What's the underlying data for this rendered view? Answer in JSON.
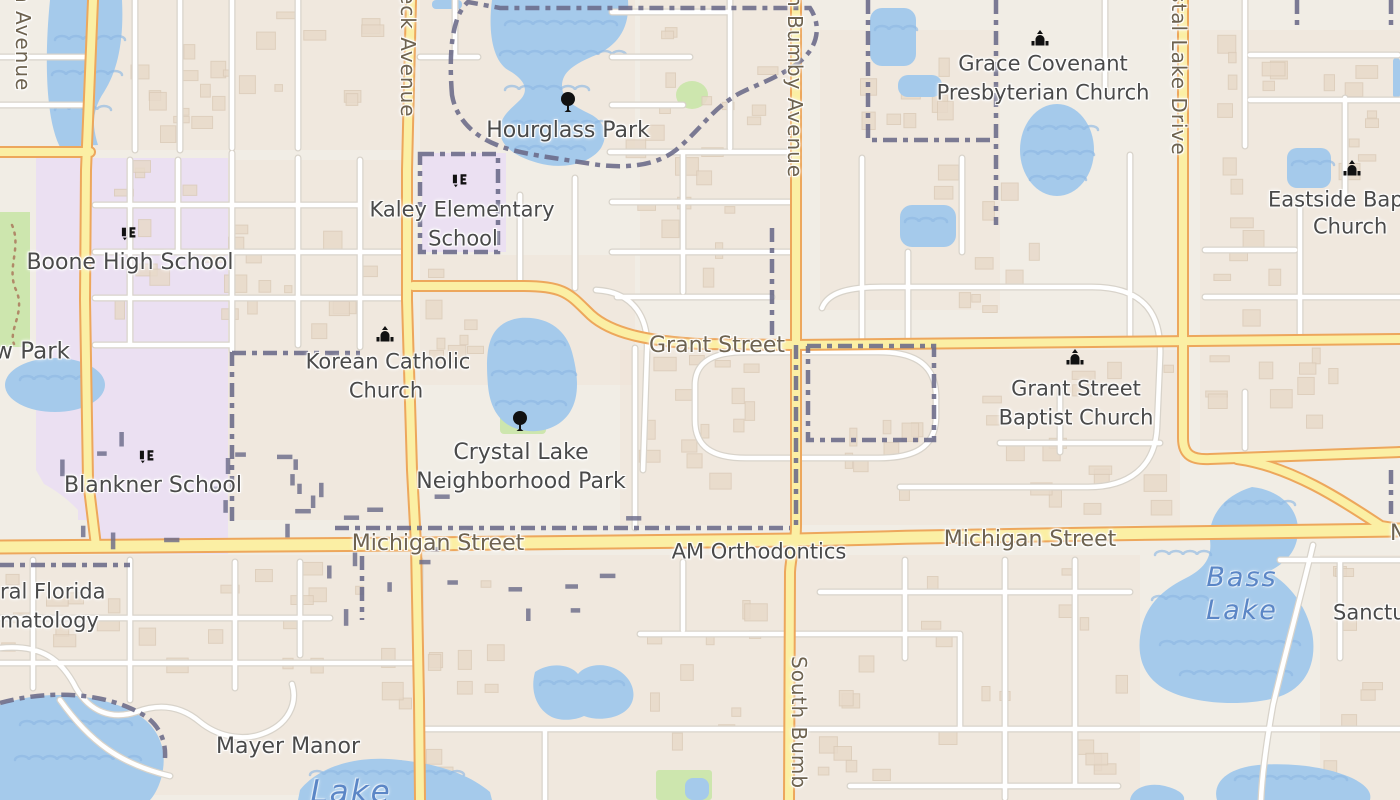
{
  "map": {
    "description": "Street map of a neighborhood (Orlando area) with schools, churches, parks and lakes",
    "colors": {
      "land": "#F1EDE5",
      "residential": "#EFE3D5",
      "water": "#A5CAEB",
      "water_wave": "#8FB9E4",
      "road_fill": "#FBEFA4",
      "road_casing": "#EDA75C",
      "street_fill": "#FFFFFF",
      "street_casing": "#D8D3CA",
      "boundary": "#6A6A89",
      "school": "#EBE0F2",
      "park": "#CDE6AE",
      "building": "#E8DACA",
      "building_stroke": "#DBCBB8",
      "poi_label": "#4A4A4A",
      "road_label": "#6E6350",
      "water_label": "#5B86C6",
      "icon": "#111111"
    },
    "labels": [
      {
        "id": "hourglass-park",
        "text": "Hourglass Park",
        "x": 568,
        "y": 131,
        "type": "poi",
        "size": 22
      },
      {
        "id": "kaley-school-line1",
        "text": "Kaley Elementary",
        "x": 462,
        "y": 210,
        "type": "poi",
        "size": 21
      },
      {
        "id": "kaley-school-line2",
        "text": "School",
        "x": 463,
        "y": 239,
        "type": "poi",
        "size": 21
      },
      {
        "id": "boone-high-school",
        "text": "Boone High School",
        "x": 130,
        "y": 263,
        "type": "poi",
        "size": 22
      },
      {
        "id": "grace-covenant-line1",
        "text": "Grace Covenant",
        "x": 1043,
        "y": 64,
        "type": "poi",
        "size": 21
      },
      {
        "id": "grace-covenant-line2",
        "text": "Presbyterian Church",
        "x": 1043,
        "y": 93,
        "type": "poi",
        "size": 21
      },
      {
        "id": "eastside-baptist-line1",
        "text": "Eastside Bap",
        "x": 1268,
        "y": 200,
        "type": "poi",
        "anchor": "left",
        "size": 21
      },
      {
        "id": "eastside-baptist-line2",
        "text": "Church",
        "x": 1313,
        "y": 227,
        "type": "poi",
        "anchor": "left",
        "size": 21
      },
      {
        "id": "korean-catholic-line1",
        "text": "Korean Catholic",
        "x": 388,
        "y": 362,
        "type": "poi",
        "size": 21
      },
      {
        "id": "korean-catholic-line2",
        "text": "Church",
        "x": 386,
        "y": 391,
        "type": "poi",
        "size": 21
      },
      {
        "id": "crystal-lake-park-line1",
        "text": "Crystal Lake",
        "x": 521,
        "y": 453,
        "type": "poi",
        "size": 22
      },
      {
        "id": "crystal-lake-park-line2",
        "text": "Neighborhood Park",
        "x": 521,
        "y": 482,
        "type": "poi",
        "size": 22
      },
      {
        "id": "grant-street-baptist-line1",
        "text": "Grant Street",
        "x": 1076,
        "y": 389,
        "type": "poi",
        "size": 21
      },
      {
        "id": "grant-street-baptist-line2",
        "text": "Baptist Church",
        "x": 1076,
        "y": 418,
        "type": "poi",
        "size": 21
      },
      {
        "id": "blankner-school",
        "text": "Blankner School",
        "x": 153,
        "y": 486,
        "type": "poi",
        "size": 22
      },
      {
        "id": "wadeview-park-partial",
        "text": "w Park",
        "x": 70,
        "y": 352,
        "type": "poi",
        "anchor": "right",
        "size": 23
      },
      {
        "id": "am-orthodontics",
        "text": "AM Orthodontics",
        "x": 759,
        "y": 552,
        "type": "poi",
        "size": 21
      },
      {
        "id": "mayer-manor",
        "text": "Mayer Manor",
        "x": 288,
        "y": 747,
        "type": "poi",
        "size": 22
      },
      {
        "id": "sanctuary-partial",
        "text": "Sanctu",
        "x": 1333,
        "y": 613,
        "type": "poi",
        "anchor": "left",
        "size": 21
      },
      {
        "id": "dermatology-partial-line1",
        "text": "ral Florida",
        "x": 0,
        "y": 592,
        "type": "poi",
        "anchor": "left",
        "size": 21
      },
      {
        "id": "dermatology-partial-line2",
        "text": "matology",
        "x": 0,
        "y": 621,
        "type": "poi",
        "anchor": "left",
        "size": 21
      },
      {
        "id": "grant-street",
        "text": "Grant Street",
        "x": 717,
        "y": 346,
        "type": "road"
      },
      {
        "id": "michigan-street-west",
        "text": "Michigan Street",
        "x": 438,
        "y": 544,
        "type": "road"
      },
      {
        "id": "michigan-street-east",
        "text": "Michigan Street",
        "x": 1030,
        "y": 540,
        "type": "road"
      },
      {
        "id": "partial-road-label-n",
        "text": "N",
        "x": 1390,
        "y": 534,
        "type": "road",
        "anchor": "left"
      },
      {
        "id": "fern-creek-avenue-partial",
        "text": "eck Avenue",
        "x": 409,
        "y": -8,
        "type": "roadv"
      },
      {
        "id": "left-avenue-partial",
        "text": "n Avenue",
        "x": 24,
        "y": -10,
        "type": "roadv"
      },
      {
        "id": "bumby-avenue-north",
        "text": "h Bumby Avenue",
        "x": 796,
        "y": -6,
        "type": "roadv"
      },
      {
        "id": "bumby-avenue-south",
        "text": "South Bumb",
        "x": 800,
        "y": 656,
        "type": "roadv"
      },
      {
        "id": "crystal-lake-drive-partial",
        "text": "stal Lake Drive",
        "x": 1180,
        "y": -8,
        "type": "roadv"
      },
      {
        "id": "bass-lake-line1",
        "text": "Bass",
        "x": 1242,
        "y": 578,
        "type": "water"
      },
      {
        "id": "bass-lake-line2",
        "text": "Lake",
        "x": 1242,
        "y": 611,
        "type": "water"
      },
      {
        "id": "lake-partial-bottom",
        "text": "Lake",
        "x": 351,
        "y": 792,
        "type": "water",
        "size": 31
      }
    ],
    "icons": [
      {
        "id": "boone-school-icon",
        "kind": "school",
        "x": 130,
        "y": 234
      },
      {
        "id": "kaley-school-icon",
        "kind": "school",
        "x": 461,
        "y": 181
      },
      {
        "id": "blankner-school-icon",
        "kind": "school",
        "x": 148,
        "y": 457
      },
      {
        "id": "grace-covenant-church-icon",
        "kind": "church",
        "x": 1040,
        "y": 38
      },
      {
        "id": "eastside-baptist-church-icon",
        "kind": "church",
        "x": 1352,
        "y": 168
      },
      {
        "id": "korean-catholic-church-icon",
        "kind": "church",
        "x": 385,
        "y": 334
      },
      {
        "id": "grant-street-baptist-church-icon",
        "kind": "church",
        "x": 1075,
        "y": 357
      },
      {
        "id": "hourglass-park-tree-icon",
        "kind": "tree",
        "x": 568,
        "y": 102
      },
      {
        "id": "crystal-lake-park-tree-icon",
        "kind": "tree",
        "x": 520,
        "y": 421
      }
    ]
  }
}
